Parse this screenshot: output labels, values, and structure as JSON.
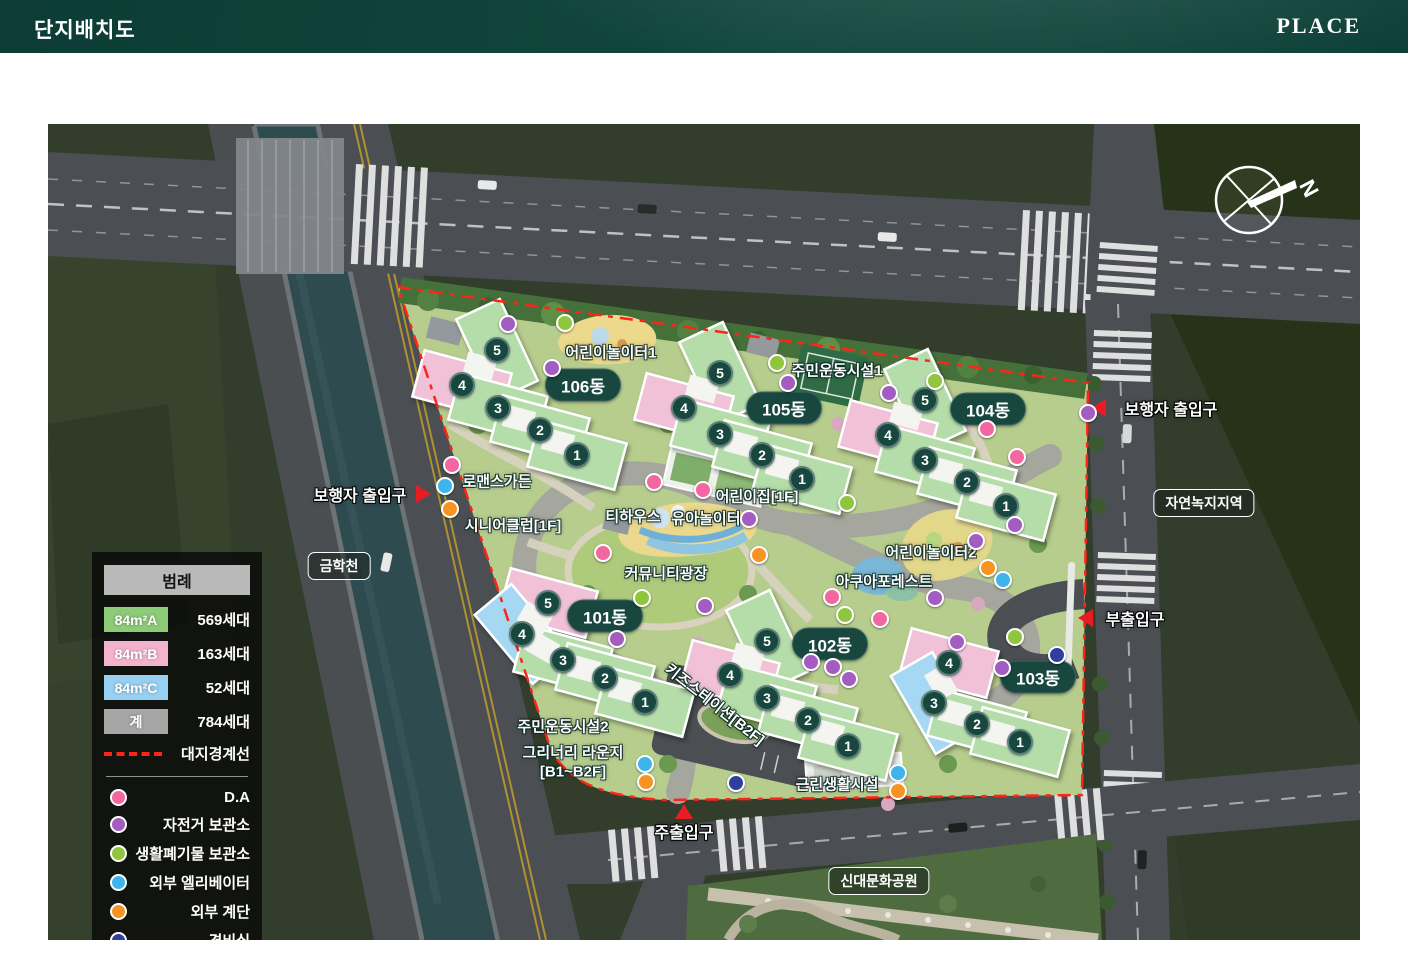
{
  "header": {
    "title": "단지배치도",
    "brand": "PLACE"
  },
  "legend": {
    "title": "범례",
    "unit_rows": [
      {
        "label": "84m²A",
        "count": "569세대",
        "color": "#8ccb77"
      },
      {
        "label": "84m²B",
        "count": "163세대",
        "color": "#f3b3cc"
      },
      {
        "label": "84m²C",
        "count": "52세대",
        "color": "#97d0f3"
      },
      {
        "label": "계",
        "count": "784세대",
        "color": "#a6a6a6"
      }
    ],
    "boundary": {
      "label": "대지경계선",
      "color": "#ff2419"
    },
    "marker_rows": [
      {
        "label": "D.A",
        "color": "#f2679f"
      },
      {
        "label": "자전거 보관소",
        "color": "#a35cc0"
      },
      {
        "label": "생활폐기물 보관소",
        "color": "#8fc63e"
      },
      {
        "label": "외부 엘리베이터",
        "color": "#3eb4ea"
      },
      {
        "label": "외부 계단",
        "color": "#f79421"
      },
      {
        "label": "경비실",
        "color": "#2e3f9e"
      }
    ]
  },
  "buildings": [
    {
      "name": "101동",
      "units": [
        {
          "n": "1",
          "type": "A"
        },
        {
          "n": "2",
          "type": "A"
        },
        {
          "n": "3",
          "type": "A"
        },
        {
          "n": "4",
          "type": "C"
        },
        {
          "n": "5",
          "type": "B"
        }
      ]
    },
    {
      "name": "102동",
      "units": [
        {
          "n": "1",
          "type": "A"
        },
        {
          "n": "2",
          "type": "A"
        },
        {
          "n": "3",
          "type": "A"
        },
        {
          "n": "4",
          "type": "B"
        },
        {
          "n": "5",
          "type": "A"
        }
      ]
    },
    {
      "name": "103동",
      "units": [
        {
          "n": "1",
          "type": "A"
        },
        {
          "n": "2",
          "type": "A"
        },
        {
          "n": "3",
          "type": "C"
        },
        {
          "n": "4",
          "type": "B"
        }
      ]
    },
    {
      "name": "104동",
      "units": [
        {
          "n": "1",
          "type": "A"
        },
        {
          "n": "2",
          "type": "A"
        },
        {
          "n": "3",
          "type": "A"
        },
        {
          "n": "4",
          "type": "B"
        },
        {
          "n": "5",
          "type": "A"
        }
      ]
    },
    {
      "name": "105동",
      "units": [
        {
          "n": "1",
          "type": "A"
        },
        {
          "n": "2",
          "type": "A"
        },
        {
          "n": "3",
          "type": "A"
        },
        {
          "n": "4",
          "type": "B"
        },
        {
          "n": "5",
          "type": "A"
        }
      ]
    },
    {
      "name": "106동",
      "units": [
        {
          "n": "1",
          "type": "A"
        },
        {
          "n": "2",
          "type": "A"
        },
        {
          "n": "3",
          "type": "A"
        },
        {
          "n": "4",
          "type": "B"
        },
        {
          "n": "5",
          "type": "A"
        }
      ]
    }
  ],
  "site_labels": [
    "어린이놀이터1",
    "주민운동시설1",
    "로맨스가든",
    "어린이집[1F]",
    "시니어클럽[1F]",
    "티하우스",
    "유아놀이터",
    "어린이놀이터2",
    "커뮤니티광장",
    "아쿠아포레스트",
    "키즈스테이션[B2F]",
    "주민운동시설2",
    "그리너리 라운지",
    "[B1~B2F]",
    "근린생활시설"
  ],
  "boxed_labels": [
    "금학천",
    "자연녹지지역",
    "신대문화공원"
  ],
  "entrances": [
    {
      "label": "보행자 출입구"
    },
    {
      "label": "보행자 출입구"
    },
    {
      "label": "부출입구"
    },
    {
      "label": "주출입구"
    }
  ],
  "compass": {
    "north": "N"
  }
}
